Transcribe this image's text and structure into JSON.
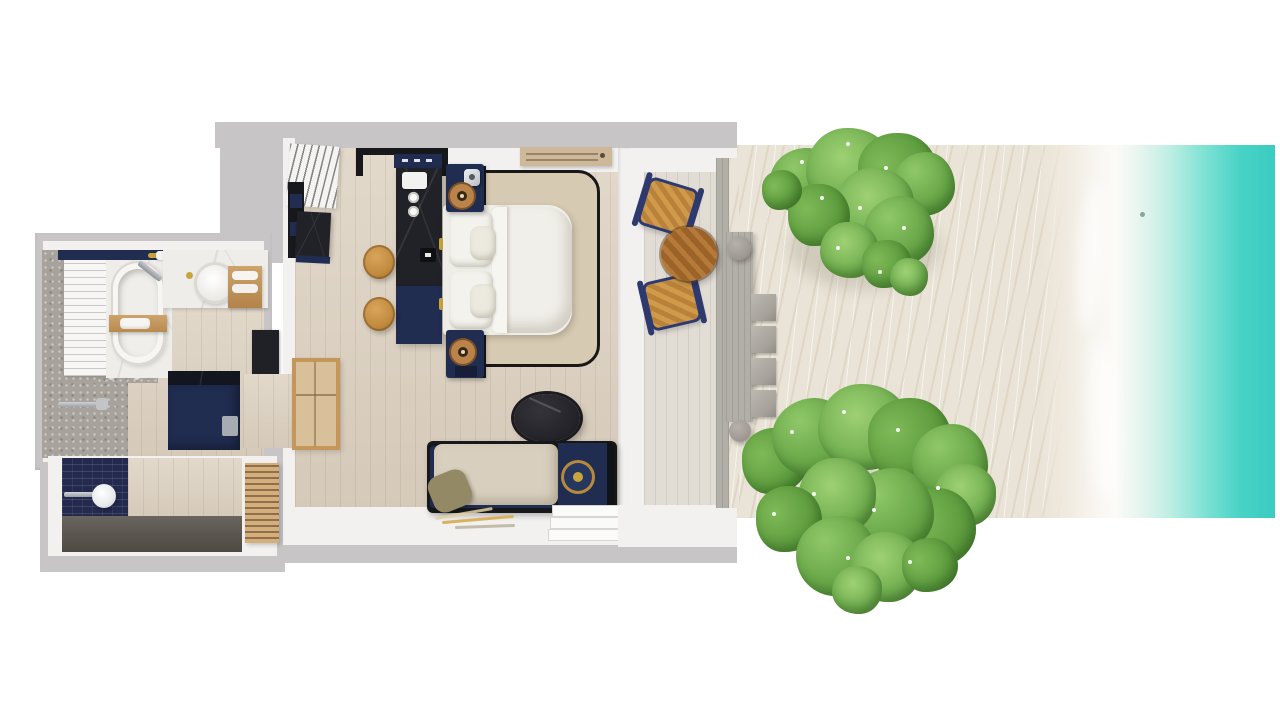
{
  "meta": {
    "description": "Top-down 3D rendered floor plan of a one-bedroom beachfront villa with en-suite bathroom, outdoor shower, sun terrace, private beach and ocean shoreline",
    "view": "top-down-render",
    "visible_text": "none"
  },
  "regions": {
    "bathroom": {
      "label": "Bathroom",
      "items": [
        "bathtub",
        "tub-caddy-tray",
        "vanity-counter",
        "vessel-sink",
        "towel-shelf",
        "towel-ladder",
        "walk-in-shower",
        "toilet-nook",
        "gold-towel-rail"
      ]
    },
    "outdoor_shower": {
      "label": "Outdoor shower",
      "items": [
        "mosaic-wall",
        "rain-shower-head",
        "timber-wall",
        "slatted-screen"
      ]
    },
    "bedroom": {
      "label": "Bedroom",
      "items": [
        "double-bed",
        "pillows",
        "area-rug",
        "nightstand-top",
        "nightstand-bottom",
        "writing-desk",
        "desk-canopy-frame",
        "wood-stools",
        "minibar-counter",
        "louvered-wardrobe",
        "luggage-rack",
        "daybed-sofa",
        "side-table",
        "oval-coffee-table",
        "feather-floor-art",
        "entry-steps",
        "ac-ceiling-vent"
      ]
    },
    "terrace": {
      "label": "Terrace",
      "items": [
        "deck",
        "lounge-chair-1",
        "lounge-chair-2",
        "round-teak-table",
        "concrete-walkway",
        "concrete-bench",
        "round-stones",
        "stepping-pavers"
      ]
    },
    "beach": {
      "label": "Beach",
      "items": [
        "sand",
        "tree-canopy-north",
        "tree-canopy-south",
        "driftwood"
      ]
    },
    "ocean": {
      "label": "Ocean",
      "items": [
        "surf-foam",
        "turquoise-water"
      ]
    }
  },
  "palette": {
    "wall_grey": "#c7c5c6",
    "wall_white": "#f2f1f0",
    "floor_wood": "#ddd2c2",
    "deck_wood": "#e1ddd5",
    "navy": "#202c50",
    "navy_dark": "#161e38",
    "black_marble": "#212228",
    "black_frame": "#17181b",
    "wood_tan": "#c59a62",
    "stool_wood": "#c9923f",
    "table_wood": "#b0772f",
    "bed_white": "#efede7",
    "rug_beige": "#d7cab2",
    "cushion_beige": "#d8cfbe",
    "olive": "#938a65",
    "stone_grey": "#a7a29b",
    "concrete": "#b2aea8",
    "dark_floor": "#57524d",
    "sand": "#eae4d8",
    "foam": "#fbfaf7",
    "water_light": "#bfeee4",
    "water": "#3fcfc5",
    "water_deep": "#38c9bf",
    "leaf_light": "#8fc868",
    "leaf": "#69a748",
    "leaf_dark": "#4f8c34",
    "gold": "#c9a43c"
  }
}
